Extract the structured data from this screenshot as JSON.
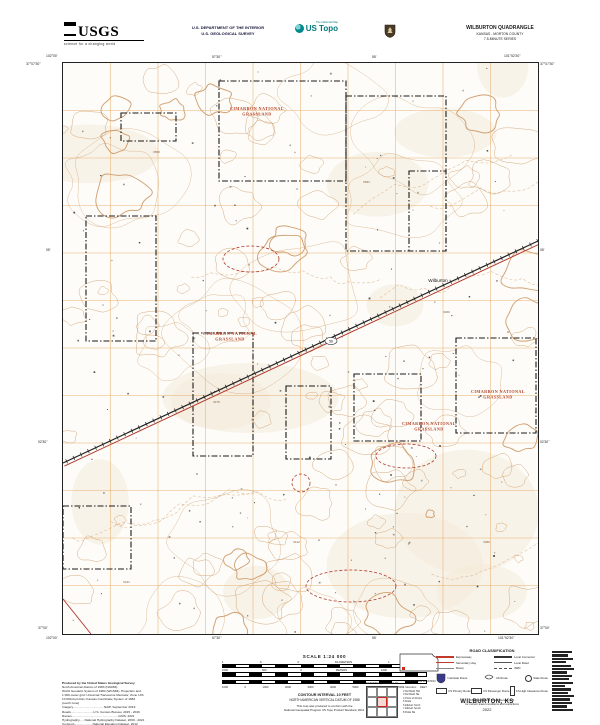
{
  "header": {
    "usgs_logo": {
      "text": "USGS",
      "tagline": "science for a changing world"
    },
    "dept_line1": "U.S. DEPARTMENT OF THE INTERIOR",
    "dept_line2": "U.S. GEOLOGICAL SURVEY",
    "ustopo": {
      "pre": "The National Map",
      "name": "US Topo"
    },
    "quad": {
      "title": "WILBURTON QUADRANGLE",
      "state_county": "KANSAS - MORTON COUNTY",
      "series": "7.5-MINUTE SERIES"
    }
  },
  "map": {
    "colors": {
      "contour": "#c58a52",
      "grid": "#e3a45f",
      "boundary": "#1a1a1a",
      "railroad": "#222222",
      "highway": "#b03a2e",
      "grassland_label": "#b5442c",
      "spot_elevation": "#8a5a33"
    },
    "grassland_label_line1": "CIMARRON NATIONAL",
    "grassland_label_line2": "GRASSLAND",
    "grassland_positions": [
      [
        194,
        47
      ],
      [
        167,
        272
      ],
      [
        366,
        362
      ],
      [
        435,
        330
      ]
    ],
    "town_label": {
      "text": "Wilburton",
      "x": 375,
      "y": 219
    },
    "route_shield": {
      "text": "56",
      "x": 268,
      "y": 278
    },
    "spot_elevations": [
      {
        "v": "3595",
        "x": 90,
        "y": 90
      },
      {
        "v": "3531",
        "x": 300,
        "y": 120
      },
      {
        "v": "3475",
        "x": 150,
        "y": 340
      },
      {
        "v": "3460",
        "x": 380,
        "y": 250
      },
      {
        "v": "3412",
        "x": 230,
        "y": 480
      },
      {
        "v": "3389",
        "x": 420,
        "y": 480
      },
      {
        "v": "3441",
        "x": 60,
        "y": 520
      }
    ],
    "boundaries": [
      [
        156,
        18,
        127,
        100
      ],
      [
        283,
        33,
        100,
        155
      ],
      [
        58,
        50,
        55,
        28
      ],
      [
        23,
        153,
        70,
        125
      ],
      [
        130,
        270,
        60,
        123
      ],
      [
        223,
        323,
        45,
        73
      ],
      [
        291,
        311,
        67,
        67
      ],
      [
        393,
        275,
        80,
        95
      ],
      [
        0,
        443,
        68,
        63
      ],
      [
        346,
        108,
        37,
        80
      ]
    ],
    "red_areas": [
      [
        188,
        196,
        28,
        13
      ],
      [
        343,
        393,
        30,
        12
      ],
      [
        288,
        523,
        45,
        16
      ],
      [
        238,
        420,
        9,
        9
      ]
    ],
    "railroad": {
      "x1": 0,
      "y1": 400,
      "x2": 475,
      "y2": 178
    },
    "corner_labels": [
      {
        "text": "102°00'",
        "x": 46,
        "y": 54
      },
      {
        "text": "37°07'30\"",
        "x": 26,
        "y": 62
      },
      {
        "text": "101°52'30\"",
        "x": 504,
        "y": 54
      },
      {
        "text": "37°07'30\"",
        "x": 540,
        "y": 62
      },
      {
        "text": "37°00'",
        "x": 38,
        "y": 626
      },
      {
        "text": "102°00'",
        "x": 46,
        "y": 636
      },
      {
        "text": "37°00'",
        "x": 540,
        "y": 626
      },
      {
        "text": "101°52'30\"",
        "x": 498,
        "y": 636
      },
      {
        "text": "57'30\"",
        "x": 212,
        "y": 55
      },
      {
        "text": "55'",
        "x": 372,
        "y": 55
      },
      {
        "text": "57'30\"",
        "x": 212,
        "y": 636
      },
      {
        "text": "55'",
        "x": 372,
        "y": 636
      },
      {
        "text": "05'",
        "x": 46,
        "y": 248
      },
      {
        "text": "02'30\"",
        "x": 38,
        "y": 440
      },
      {
        "text": "05'",
        "x": 540,
        "y": 248
      },
      {
        "text": "02'30\"",
        "x": 540,
        "y": 440
      }
    ]
  },
  "footer": {
    "credits": [
      "Produced by the United States Geological Survey",
      "North American Datum of 1983 (NAD83)",
      "World Geodetic System of 1984 (WGS84). Projection and",
      "1 000-meter grid: Universal Transverse Mercator, Zone 13S",
      "10 000-foot ticks: Kansas Coordinate System of 1983",
      "(south zone)",
      "Imagery....................................NAIP, September 2019",
      "Roads..........................U.S. Census Bureau, 2015 - 2016",
      "Names......................................................GNIS, 2021",
      "Hydrography......National Hydrography Dataset, 2009 - 2021",
      "Contours.....................National Elevation Dataset, 2012",
      "Boundaries......Multiple sources; Census, IBWC, IBC, USGS,",
      "1972 - 2021"
    ],
    "scale": {
      "title": "SCALE 1:24 000",
      "km_labels": [
        "1",
        ".5",
        "0",
        "KILOMETERS",
        "1",
        "2"
      ],
      "m_labels": [
        "1000",
        "500",
        "0",
        "METERS",
        "1000",
        "2000"
      ],
      "ft_labels": [
        "1000",
        "0",
        "1000",
        "2000",
        "3000",
        "4000",
        "5000",
        "6000",
        "7000",
        "FEET"
      ],
      "contour_interval": "CONTOUR INTERVAL 10 FEET",
      "datum": "NORTH AMERICAN VERTICAL DATUM OF 1988",
      "conform1": "This map was produced to conform with the",
      "conform2": "National Geospatial Program US Topo Product Standard, 2011."
    },
    "location": {
      "caption": "QUADRANGLE LOCATION"
    },
    "legend": {
      "title": "ROAD CLASSIFICATION",
      "rows": [
        {
          "label": "Expressway",
          "style": "expressway"
        },
        {
          "label": "Local Connector",
          "style": "connector"
        },
        {
          "label": "Secondary Hwy",
          "style": "secondary"
        },
        {
          "label": "Local Road",
          "style": "local"
        },
        {
          "label": "Ramp",
          "style": "ramp"
        },
        {
          "label": "4WD",
          "style": "fourwd"
        }
      ],
      "shields": [
        "Interstate Route",
        "US Route",
        "State Route"
      ],
      "fs_routes": [
        "FS Primary Route",
        "FS Passenger Route",
        "FS High Clearance Route"
      ],
      "note1": "Check with local Forest Service unit",
      "note2": "for current travel conditions and restrictions"
    },
    "adjoining": {
      "caption": "ADJOINING QUADRANGLES",
      "list": [
        "1  Saunders",
        "2  Richfield SW",
        "3  Richfield SE",
        "4  Point of Rocks",
        "5  Rolla",
        "6  Elkhart North",
        "7  Elkhart South",
        "8  Rolla SE"
      ]
    },
    "sheet": {
      "title": "WILBURTON, KS",
      "year": "2022"
    },
    "barcode_bars": [
      20,
      16,
      21,
      14,
      19,
      22,
      15,
      20,
      17,
      21,
      13,
      19,
      16,
      22,
      18,
      20,
      15,
      21
    ]
  }
}
